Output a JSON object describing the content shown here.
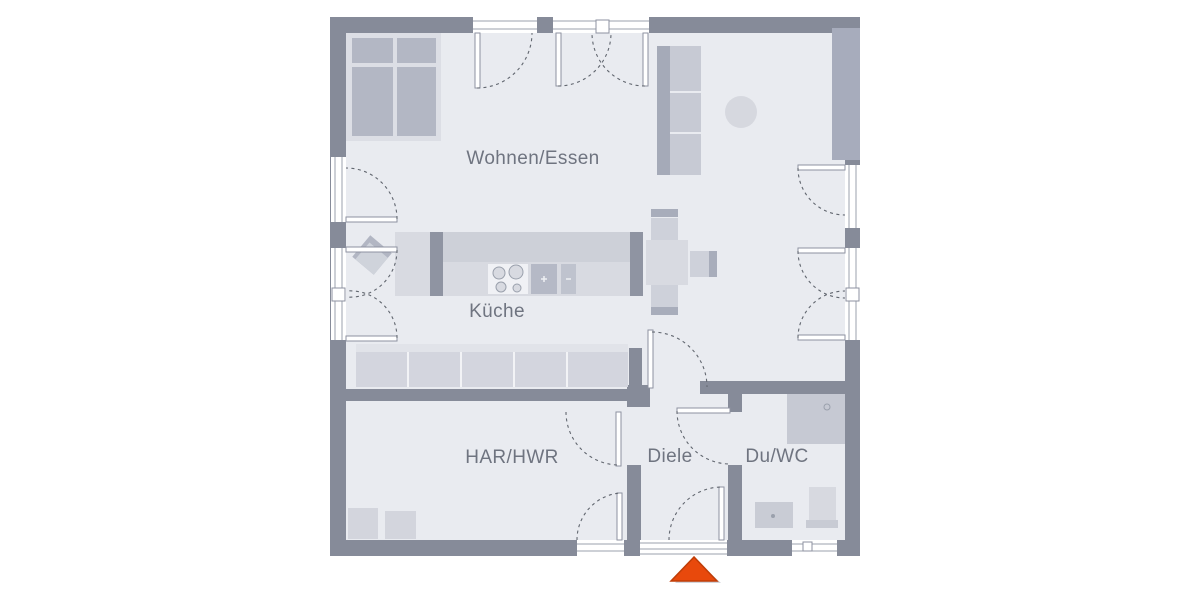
{
  "floorplan": {
    "rooms": [
      {
        "id": "wohnen-essen",
        "label": "Wohnen/Essen"
      },
      {
        "id": "kueche",
        "label": "Küche"
      },
      {
        "id": "har-hwr",
        "label": "HAR/HWR"
      },
      {
        "id": "diele",
        "label": "Diele"
      },
      {
        "id": "du-wc",
        "label": "Du/WC"
      }
    ],
    "entrance_marker": {
      "icon": "entrance-arrow-icon",
      "direction": "up",
      "color": "#e8490c",
      "edge_color": "#bf3d07"
    },
    "colors": {
      "wall": "#868b99",
      "floor": "#e9ebf0",
      "accent": "#e8490c",
      "furniture_light": "#d7d9e1",
      "furniture_medium": "#b3b7c4",
      "window": "#ffffff"
    }
  }
}
